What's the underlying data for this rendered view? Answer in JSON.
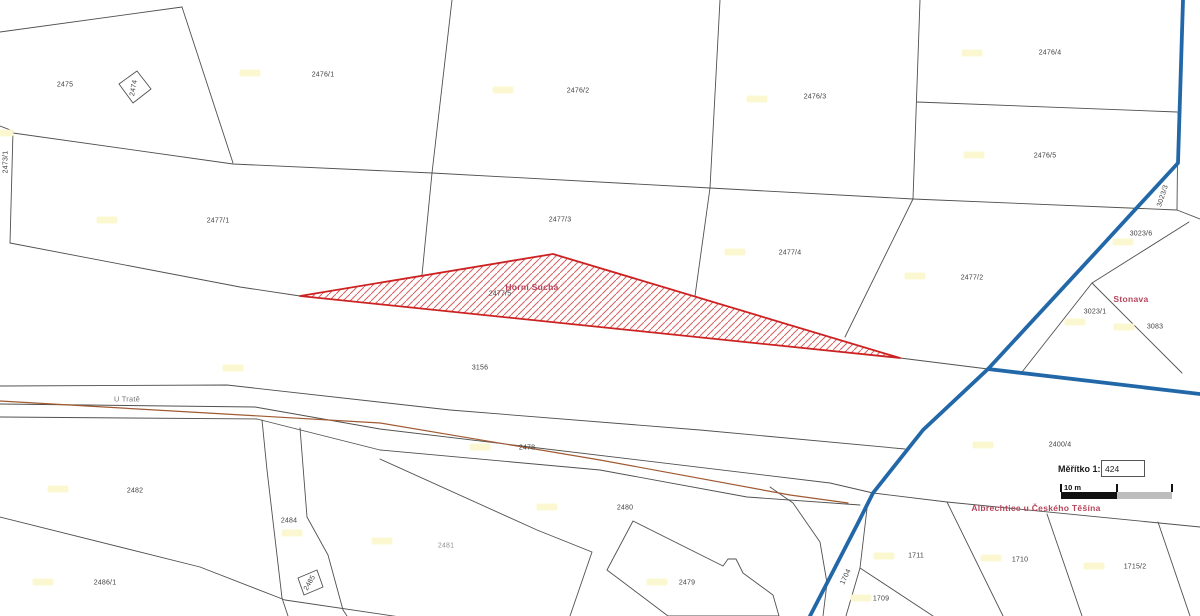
{
  "app": {
    "type": "cadastral-map-view"
  },
  "scale_widget": {
    "title": "Měřítko 1:",
    "value": "424",
    "bar_label": "10 m"
  },
  "highlight": {
    "parcel_number": "2477/5",
    "territory_name": "Horní Suchá"
  },
  "colors": {
    "boundary": "#50504e",
    "cadastre_boundary": "#2268a8",
    "railway": "#a05a32",
    "highlight_border": "#cc2222",
    "highlight_hatch": "#d86060",
    "territory_text": "#b5455a",
    "parcel_text": "#3f3f3f",
    "muted_text": "#909090",
    "yellow_marker": "#fbf8cf"
  },
  "labels": {
    "parcels": [
      {
        "text": "2475",
        "x": 65,
        "y": 85
      },
      {
        "text": "2474",
        "x": 134,
        "y": 88,
        "rot": -80
      },
      {
        "text": "2473/1",
        "x": 6,
        "y": 162,
        "rot": -90
      },
      {
        "text": "2476/1",
        "x": 323,
        "y": 75
      },
      {
        "text": "2476/2",
        "x": 578,
        "y": 91
      },
      {
        "text": "2476/3",
        "x": 815,
        "y": 97
      },
      {
        "text": "2476/4",
        "x": 1050,
        "y": 53
      },
      {
        "text": "2476/5",
        "x": 1045,
        "y": 156
      },
      {
        "text": "2477/1",
        "x": 218,
        "y": 221
      },
      {
        "text": "2477/3",
        "x": 560,
        "y": 220
      },
      {
        "text": "2477/4",
        "x": 790,
        "y": 253
      },
      {
        "text": "2477/2",
        "x": 972,
        "y": 278
      },
      {
        "text": "2477/5",
        "x": 500,
        "y": 294
      },
      {
        "text": "3023/3",
        "x": 1163,
        "y": 196,
        "rot": -72
      },
      {
        "text": "3023/6",
        "x": 1141,
        "y": 234
      },
      {
        "text": "3023/1",
        "x": 1095,
        "y": 312
      },
      {
        "text": "3083",
        "x": 1155,
        "y": 327
      },
      {
        "text": "3156",
        "x": 480,
        "y": 368
      },
      {
        "text": "2478",
        "x": 527,
        "y": 448
      },
      {
        "text": "2480",
        "x": 625,
        "y": 508
      },
      {
        "text": "2482",
        "x": 135,
        "y": 491
      },
      {
        "text": "2484",
        "x": 289,
        "y": 521
      },
      {
        "text": "2485",
        "x": 310,
        "y": 583,
        "rot": -60
      },
      {
        "text": "2486/1",
        "x": 105,
        "y": 583
      },
      {
        "text": "2479",
        "x": 687,
        "y": 583
      },
      {
        "text": "2400/4",
        "x": 1060,
        "y": 445
      },
      {
        "text": "1704",
        "x": 846,
        "y": 577,
        "rot": -65
      },
      {
        "text": "1711",
        "x": 916,
        "y": 556
      },
      {
        "text": "1710",
        "x": 1020,
        "y": 560
      },
      {
        "text": "1715/2",
        "x": 1135,
        "y": 567
      },
      {
        "text": "1709",
        "x": 881,
        "y": 599
      }
    ],
    "muted": [
      {
        "text": "2481",
        "x": 446,
        "y": 546
      }
    ],
    "street": {
      "text": "U Tratě",
      "x": 127,
      "y": 399
    },
    "territories": [
      {
        "text": "Horní Suchá",
        "x": 532,
        "y": 287
      },
      {
        "text": "Stonava",
        "x": 1131,
        "y": 299
      },
      {
        "text": "Albrechtice u Českého Těšína",
        "x": 1036,
        "y": 508
      }
    ]
  },
  "yellow_markers": [
    [
      250,
      73
    ],
    [
      503,
      90
    ],
    [
      757,
      99
    ],
    [
      972,
      53
    ],
    [
      974,
      155
    ],
    [
      107,
      220
    ],
    [
      3,
      133
    ],
    [
      735,
      252
    ],
    [
      915,
      276
    ],
    [
      1123,
      242
    ],
    [
      1075,
      322
    ],
    [
      1124,
      327
    ],
    [
      233,
      368
    ],
    [
      58,
      489
    ],
    [
      43,
      582
    ],
    [
      292,
      533
    ],
    [
      547,
      507
    ],
    [
      480,
      447
    ],
    [
      657,
      582
    ],
    [
      884,
      556
    ],
    [
      991,
      558
    ],
    [
      1094,
      566
    ],
    [
      861,
      598
    ],
    [
      983,
      445
    ],
    [
      382,
      541
    ]
  ],
  "geometry": {
    "thin": [
      [
        [
          0,
          32
        ],
        [
          182,
          7
        ]
      ],
      [
        [
          182,
          7
        ],
        [
          233,
          163
        ]
      ],
      [
        [
          0,
          126
        ],
        [
          13,
          131
        ],
        [
          10,
          243
        ]
      ],
      [
        [
          13,
          133
        ],
        [
          233,
          164
        ],
        [
          432,
          173
        ],
        [
          710,
          188
        ],
        [
          913,
          199
        ],
        [
          1177,
          210
        ]
      ],
      [
        [
          452,
          0
        ],
        [
          432,
          173
        ]
      ],
      [
        [
          720,
          0
        ],
        [
          710,
          188
        ]
      ],
      [
        [
          920,
          0
        ],
        [
          913,
          199
        ]
      ],
      [
        [
          917,
          102
        ],
        [
          1177,
          112
        ]
      ],
      [
        [
          1178,
          112
        ],
        [
          1177,
          210
        ]
      ],
      [
        [
          1177,
          210
        ],
        [
          1200,
          219
        ]
      ],
      [
        [
          432,
          173
        ],
        [
          422,
          275
        ]
      ],
      [
        [
          710,
          188
        ],
        [
          695,
          296
        ]
      ],
      [
        [
          913,
          199
        ],
        [
          845,
          337
        ]
      ],
      [
        [
          10,
          243
        ],
        [
          240,
          287
        ],
        [
          300,
          296
        ],
        [
          900,
          358
        ],
        [
          988,
          369
        ]
      ],
      [
        [
          1189,
          222
        ],
        [
          1092,
          283
        ]
      ],
      [
        [
          1092,
          283
        ],
        [
          1022,
          372
        ]
      ],
      [
        [
          1092,
          283
        ],
        [
          1182,
          373
        ]
      ],
      [
        [
          0,
          386
        ],
        [
          227,
          385
        ],
        [
          450,
          410
        ],
        [
          700,
          430
        ],
        [
          905,
          449
        ]
      ],
      [
        [
          0,
          404
        ],
        [
          255,
          407
        ],
        [
          380,
          429
        ],
        [
          830,
          483
        ],
        [
          873,
          493
        ],
        [
          947,
          502
        ],
        [
          1200,
          527
        ]
      ],
      [
        [
          0,
          417
        ],
        [
          257,
          419
        ],
        [
          380,
          450
        ],
        [
          600,
          470
        ],
        [
          747,
          497
        ],
        [
          860,
          505
        ]
      ],
      [
        [
          262,
          420
        ],
        [
          267,
          470
        ],
        [
          282,
          598
        ],
        [
          288,
          616
        ]
      ],
      [
        [
          300,
          428
        ],
        [
          307,
          517
        ],
        [
          328,
          555
        ],
        [
          343,
          610
        ],
        [
          347,
          616
        ]
      ],
      [
        [
          0,
          517
        ],
        [
          200,
          567
        ],
        [
          285,
          600
        ],
        [
          400,
          617
        ]
      ],
      [
        [
          380,
          459
        ],
        [
          537,
          530
        ],
        [
          592,
          552
        ],
        [
          570,
          616
        ]
      ],
      [
        [
          770,
          487
        ],
        [
          793,
          503
        ],
        [
          820,
          542
        ],
        [
          827,
          583
        ],
        [
          823,
          616
        ]
      ],
      [
        [
          868,
          500
        ],
        [
          860,
          568
        ],
        [
          933,
          616
        ]
      ],
      [
        [
          860,
          568
        ],
        [
          846,
          616
        ]
      ],
      [
        [
          947,
          502
        ],
        [
          1003,
          616
        ]
      ],
      [
        [
          1047,
          514
        ],
        [
          1082,
          616
        ]
      ],
      [
        [
          1158,
          522
        ],
        [
          1190,
          616
        ]
      ]
    ],
    "buildings": [
      [
        [
          119,
          84
        ],
        [
          137,
          71
        ],
        [
          151,
          89
        ],
        [
          133,
          103
        ],
        [
          119,
          84
        ]
      ],
      [
        [
          298,
          578
        ],
        [
          317,
          570
        ],
        [
          323,
          587
        ],
        [
          304,
          595
        ],
        [
          298,
          578
        ]
      ],
      [
        [
          633,
          521
        ],
        [
          723,
          566
        ],
        [
          728,
          559
        ],
        [
          736,
          559
        ],
        [
          743,
          573
        ],
        [
          773,
          595
        ],
        [
          779,
          616
        ],
        [
          668,
          616
        ],
        [
          607,
          570
        ],
        [
          633,
          521
        ]
      ]
    ],
    "blue": [
      [
        [
          1183,
          0
        ],
        [
          1178,
          163
        ],
        [
          1098,
          250
        ],
        [
          988,
          369
        ],
        [
          923,
          430
        ],
        [
          873,
          493
        ],
        [
          858,
          523
        ],
        [
          810,
          616
        ]
      ],
      [
        [
          988,
          369
        ],
        [
          1200,
          394
        ]
      ]
    ],
    "brown": [
      [
        [
          0,
          401
        ],
        [
          380,
          423
        ],
        [
          600,
          460
        ],
        [
          790,
          495
        ],
        [
          848,
          503
        ]
      ]
    ],
    "red_triangle": [
      [
        300,
        296
      ],
      [
        553,
        254
      ],
      [
        900,
        358
      ]
    ]
  }
}
